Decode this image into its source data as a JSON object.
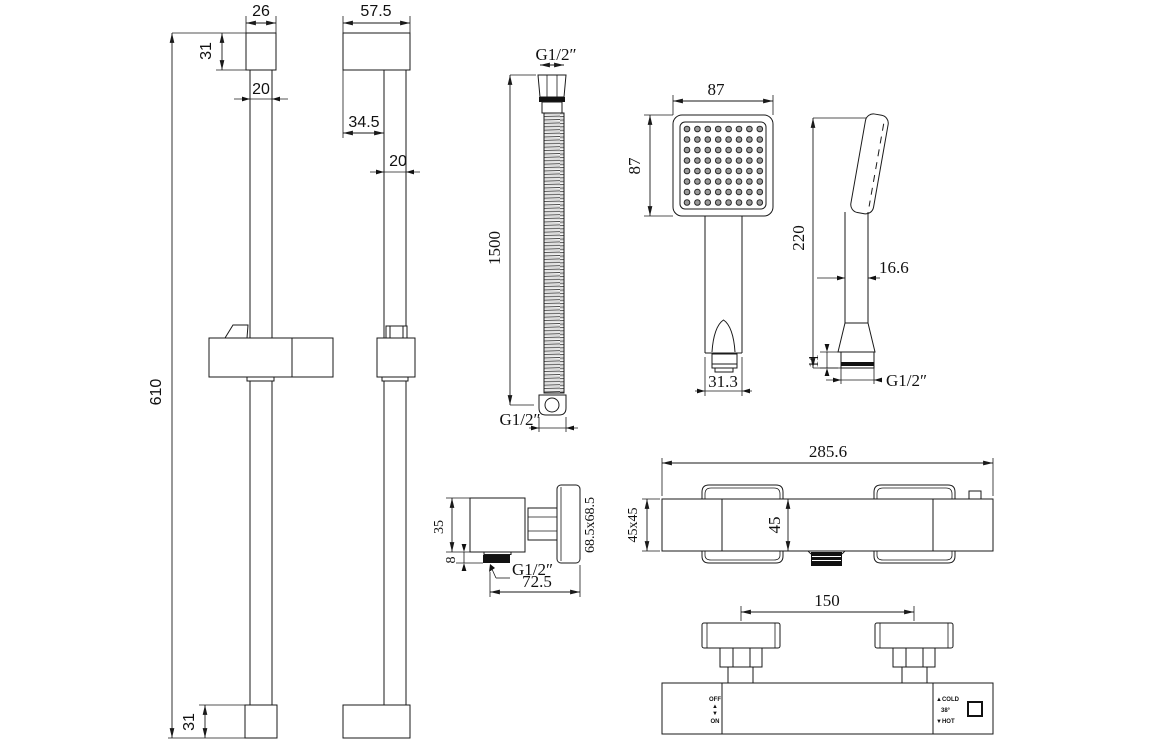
{
  "drawing": {
    "views": {
      "rail_front": {
        "cap_width": "26",
        "cap_height": "31",
        "tube_width": "20",
        "total_height": "610",
        "bottom_cap_height": "31"
      },
      "rail_side": {
        "cap_width": "57.5",
        "wall_offset": "34.5",
        "tube_width": "20"
      },
      "hose": {
        "top_thread": "G1/2″",
        "length": "1500",
        "bottom_thread": "G1/2″"
      },
      "handset_front": {
        "face_width": "87",
        "face_height": "87",
        "handle_width": "31.3",
        "nozzle_grid": {
          "rows": 8,
          "cols": 8,
          "start_x": 687,
          "start_y": 129,
          "dx": 10.4,
          "dy": 10.5,
          "r": 2.8
        }
      },
      "handset_side": {
        "total_height": "220",
        "grip_width": "16.6",
        "nut_height": "11",
        "thread": "G1/2″"
      },
      "wall_elbow": {
        "body_height": "35",
        "nut_height": "8",
        "thread": "G1/2″",
        "total_depth": "72.5",
        "plate_size": "68.5x68.5"
      },
      "valve_top": {
        "total_width": "285.6",
        "body_section": "45x45",
        "body_depth": "45"
      },
      "valve_front": {
        "inlet_spacing": "150",
        "off_label": "OFF",
        "up_arrow": "▲",
        "down_arrow": "▼",
        "on_label": "ON",
        "cold_label": "▲COLD",
        "temp_label": "38°",
        "hot_label": "▼HOT"
      }
    }
  }
}
